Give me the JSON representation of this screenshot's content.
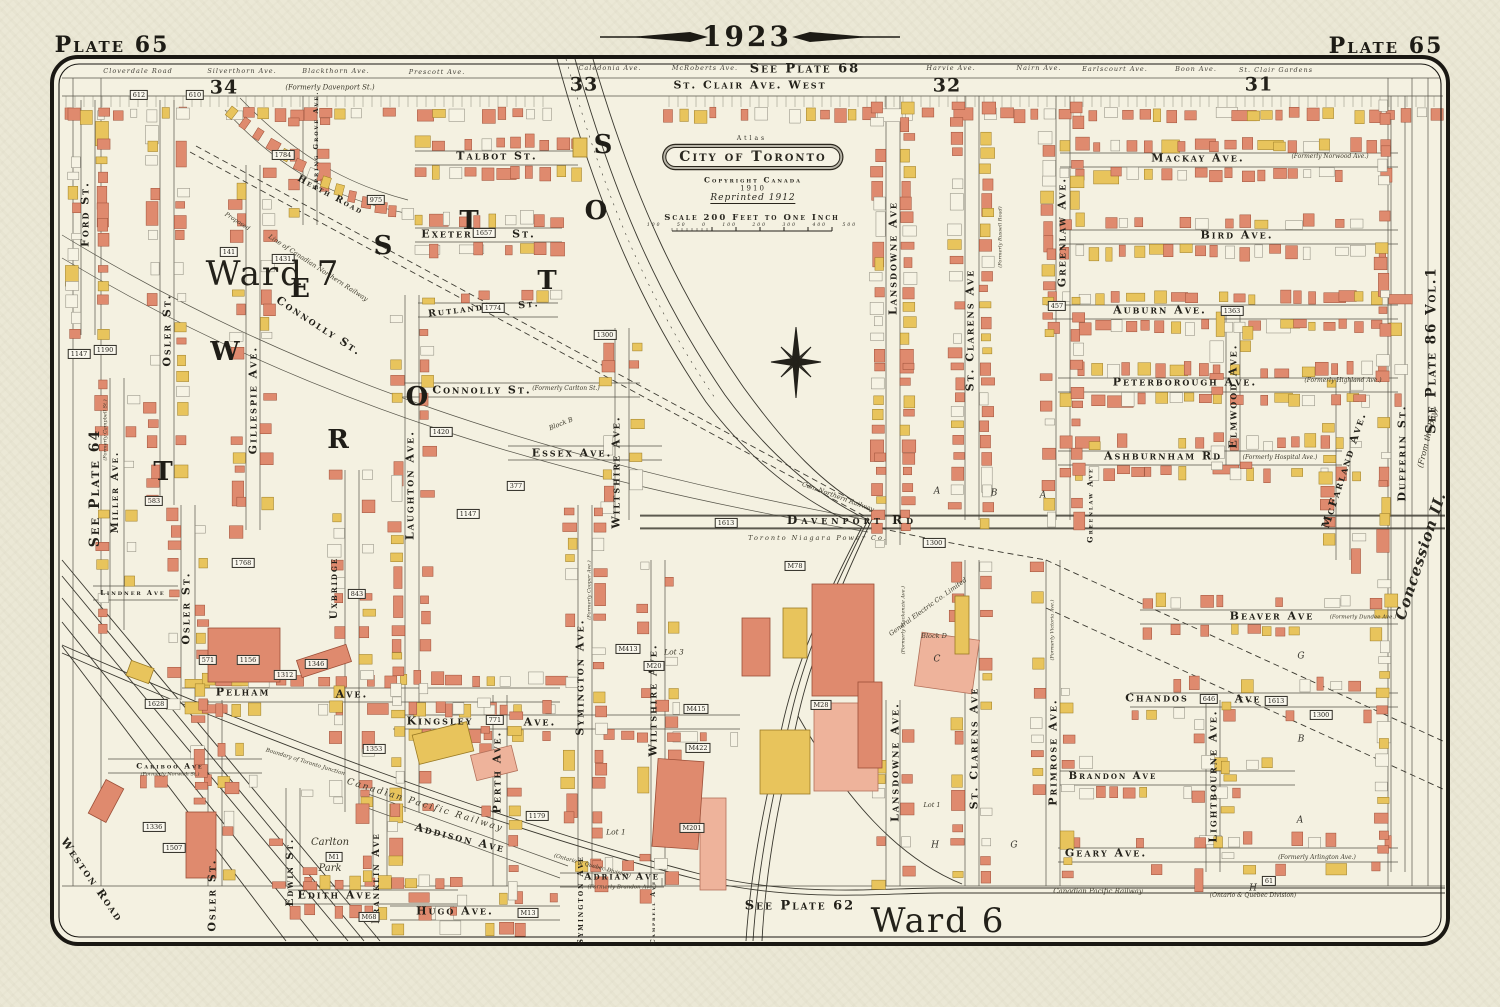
{
  "header": {
    "year": "1923",
    "plate_left": "Plate 65",
    "plate_right": "Plate 65"
  },
  "edges": {
    "top": "See Plate 68",
    "left": "See Plate 64",
    "right": "See Plate 86 Vol.1",
    "right_note": "(From the Bay)",
    "concession": "Concession II.",
    "bottom": "See Plate 62"
  },
  "wards": {
    "ward7": "Ward 7",
    "ward6": "Ward 6"
  },
  "railway_bottom": {
    "name": "Canadian Pacific Railway",
    "division": "(Ontario & Quebec Division)"
  },
  "cartouche": {
    "atlas": "Atlas",
    "title": "City of Toronto",
    "copyright": "Copyright Canada",
    "year": "1910",
    "reprint": "Reprinted 1912",
    "scale": "Scale 200 Feet to One Inch",
    "ticks": "100 50 0 100 200 300 400 500"
  },
  "top_row": {
    "st_clair": "St. Clair Ave. West",
    "streets": [
      {
        "t": "Cloverdale Road",
        "x": 138,
        "y": 71
      },
      {
        "t": "Silverthorn Ave.",
        "x": 242,
        "y": 71
      },
      {
        "t": "Blackthorn Ave.",
        "x": 336,
        "y": 71
      },
      {
        "t": "Prescott Ave.",
        "x": 437,
        "y": 72
      },
      {
        "t": "Caledonia Ave.",
        "x": 610,
        "y": 68
      },
      {
        "t": "McRoberts Ave.",
        "x": 705,
        "y": 68
      },
      {
        "t": "Harvie Ave.",
        "x": 951,
        "y": 68
      },
      {
        "t": "Nairn Ave.",
        "x": 1039,
        "y": 68
      },
      {
        "t": "Earlscourt Ave.",
        "x": 1115,
        "y": 69
      },
      {
        "t": "Boon Ave.",
        "x": 1196,
        "y": 69
      },
      {
        "t": "St. Clair Gardens",
        "x": 1276,
        "y": 70
      }
    ]
  },
  "sections": [
    {
      "n": "34",
      "x": 224,
      "y": 88,
      "note": "(Formerly Davenport St.)",
      "nx": 330,
      "ny": 88
    },
    {
      "n": "33",
      "x": 584,
      "y": 85
    },
    {
      "n": "32",
      "x": 947,
      "y": 86
    },
    {
      "n": "31",
      "x": 1259,
      "y": 85
    }
  ],
  "street_labels": [
    {
      "t": "Talbot St.",
      "x": 497,
      "y": 156,
      "s": 11
    },
    {
      "t": "Exeter",
      "x": 447,
      "y": 234,
      "s": 11
    },
    {
      "t": "St.",
      "x": 524,
      "y": 234,
      "s": 11
    },
    {
      "t": "Rutland",
      "x": 456,
      "y": 311,
      "s": 9.5,
      "r": -7
    },
    {
      "t": "St.",
      "x": 529,
      "y": 305,
      "s": 9.5,
      "r": -7
    },
    {
      "t": "Connolly St.",
      "x": 319,
      "y": 326,
      "s": 11,
      "r": 33
    },
    {
      "t": "Connolly St.",
      "x": 482,
      "y": 390,
      "s": 11
    },
    {
      "t": "Essex Ave.",
      "x": 572,
      "y": 453,
      "s": 11
    },
    {
      "t": "Davenport Rd",
      "x": 852,
      "y": 520,
      "s": 12,
      "ls": 4
    },
    {
      "t": "Pelham",
      "x": 243,
      "y": 692,
      "s": 11
    },
    {
      "t": "Ave.",
      "x": 352,
      "y": 694,
      "s": 11
    },
    {
      "t": "Kingsley",
      "x": 440,
      "y": 721,
      "s": 11
    },
    {
      "t": "Ave.",
      "x": 540,
      "y": 722,
      "s": 11
    },
    {
      "t": "Adrian Ave",
      "x": 622,
      "y": 877,
      "s": 9.5
    },
    {
      "t": "Addison Ave",
      "x": 460,
      "y": 838,
      "s": 11,
      "r": 14
    },
    {
      "t": "Edith Ave.",
      "x": 338,
      "y": 895,
      "s": 11
    },
    {
      "t": "Hugo Ave.",
      "x": 455,
      "y": 911,
      "s": 11
    },
    {
      "t": "Cariboo Ave",
      "x": 170,
      "y": 766,
      "s": 7.5
    },
    {
      "t": "Lindner Ave",
      "x": 133,
      "y": 593,
      "s": 6.5
    },
    {
      "t": "Mackay Ave.",
      "x": 1198,
      "y": 158,
      "s": 11
    },
    {
      "t": "Bird Ave.",
      "x": 1237,
      "y": 235,
      "s": 11
    },
    {
      "t": "Auburn Ave.",
      "x": 1160,
      "y": 310,
      "s": 11
    },
    {
      "t": "Peterborough Ave.",
      "x": 1185,
      "y": 382,
      "s": 11
    },
    {
      "t": "Ashburnham Rd",
      "x": 1163,
      "y": 456,
      "s": 11
    },
    {
      "t": "Beaver Ave",
      "x": 1272,
      "y": 616,
      "s": 11
    },
    {
      "t": "Chandos",
      "x": 1157,
      "y": 698,
      "s": 11
    },
    {
      "t": "Ave",
      "x": 1248,
      "y": 699,
      "s": 11
    },
    {
      "t": "Brandon Ave",
      "x": 1113,
      "y": 777,
      "s": 10
    },
    {
      "t": "Geary Ave.",
      "x": 1106,
      "y": 853,
      "s": 11
    },
    {
      "t": "Ford St.",
      "x": 85,
      "y": 214,
      "s": 11,
      "r": -90
    },
    {
      "t": "Osler St.",
      "x": 167,
      "y": 330,
      "s": 11,
      "r": -90
    },
    {
      "t": "Osler St.",
      "x": 186,
      "y": 608,
      "s": 11,
      "r": -90
    },
    {
      "t": "Osler St.",
      "x": 212,
      "y": 895,
      "s": 11,
      "r": -90
    },
    {
      "t": "Miller Ave.",
      "x": 116,
      "y": 492,
      "s": 10,
      "r": -90
    },
    {
      "t": "Gillespie Ave.",
      "x": 253,
      "y": 400,
      "s": 11,
      "r": -90
    },
    {
      "t": "Spring Grove Ave.",
      "x": 316,
      "y": 140,
      "s": 6.5,
      "r": -90
    },
    {
      "t": "Heath Road",
      "x": 330,
      "y": 196,
      "s": 9,
      "r": 28
    },
    {
      "t": "Laughton Ave.",
      "x": 410,
      "y": 485,
      "s": 11,
      "r": -90
    },
    {
      "t": "Uxbridge",
      "x": 335,
      "y": 588,
      "s": 10,
      "r": -90
    },
    {
      "t": "Wiltshire Ave.",
      "x": 616,
      "y": 472,
      "s": 11,
      "r": -90
    },
    {
      "t": "Wiltshire Ave.",
      "x": 653,
      "y": 700,
      "s": 11,
      "r": -90
    },
    {
      "t": "Symington Ave.",
      "x": 580,
      "y": 677,
      "s": 11,
      "r": -90
    },
    {
      "t": "Symington Ave",
      "x": 580,
      "y": 900,
      "s": 8,
      "r": -90
    },
    {
      "t": "Perth Ave.",
      "x": 497,
      "y": 772,
      "s": 11,
      "r": -90
    },
    {
      "t": "Franklin Ave",
      "x": 377,
      "y": 878,
      "s": 10,
      "r": -90
    },
    {
      "t": "Edwin St.",
      "x": 291,
      "y": 872,
      "s": 10,
      "r": -90
    },
    {
      "t": "Campbell Ave",
      "x": 654,
      "y": 912,
      "s": 6,
      "r": -90
    },
    {
      "t": "Lansdowne Ave",
      "x": 893,
      "y": 258,
      "s": 11,
      "r": -90
    },
    {
      "t": "Lansdowne Ave.",
      "x": 895,
      "y": 762,
      "s": 11,
      "r": -90
    },
    {
      "t": "St. Clarens Ave",
      "x": 970,
      "y": 330,
      "s": 11,
      "r": -90
    },
    {
      "t": "St. Clarens Ave",
      "x": 974,
      "y": 748,
      "s": 11,
      "r": -90
    },
    {
      "t": "Greenlaw Ave.",
      "x": 1062,
      "y": 232,
      "s": 11,
      "r": -90
    },
    {
      "t": "Greenlaw Ave",
      "x": 1090,
      "y": 505,
      "s": 7.5,
      "r": -90
    },
    {
      "t": "Primrose Ave.",
      "x": 1053,
      "y": 752,
      "s": 11,
      "r": -90
    },
    {
      "t": "Elmwood Ave.",
      "x": 1233,
      "y": 396,
      "s": 11,
      "r": -90
    },
    {
      "t": "McFarland Ave.",
      "x": 1344,
      "y": 470,
      "s": 11,
      "r": -72
    },
    {
      "t": "Lightbourne Ave.",
      "x": 1213,
      "y": 776,
      "s": 11,
      "r": -90
    },
    {
      "t": "Dufferin St.",
      "x": 1402,
      "y": 453,
      "s": 11,
      "r": -90
    },
    {
      "t": "Weston Road",
      "x": 92,
      "y": 880,
      "s": 11,
      "r": 55
    }
  ],
  "annotations": [
    {
      "t": "(Formerly Carlton St.)",
      "x": 566,
      "y": 389,
      "s": 6
    },
    {
      "t": "(Formerly Brandon Ave.)",
      "x": 622,
      "y": 888,
      "s": 5.5
    },
    {
      "t": "(Formerly Norwich St.)",
      "x": 170,
      "y": 775,
      "s": 5
    },
    {
      "t": "(Formerly Norwood Ave.)",
      "x": 1330,
      "y": 157,
      "s": 6
    },
    {
      "t": "(Formerly Highland Ave.)",
      "x": 1343,
      "y": 381,
      "s": 6
    },
    {
      "t": "(Formerly Hospital Ave.)",
      "x": 1280,
      "y": 458,
      "s": 6
    },
    {
      "t": "(Formerly Dundee Ave.)",
      "x": 1363,
      "y": 618,
      "s": 5.5
    },
    {
      "t": "(Formerly Arlington Ave.)",
      "x": 1317,
      "y": 858,
      "s": 6
    },
    {
      "t": "(Formerly Campbell St.)",
      "x": 106,
      "y": 430,
      "s": 5,
      "r": -90
    },
    {
      "t": "(Formerly Cooper Ave.)",
      "x": 590,
      "y": 590,
      "s": 5,
      "r": -90
    },
    {
      "t": "(Formerly Mackenzie Ave.)",
      "x": 904,
      "y": 620,
      "s": 5,
      "r": -90
    },
    {
      "t": "(Formerly Russell Road)",
      "x": 1001,
      "y": 237,
      "s": 5,
      "r": -90
    },
    {
      "t": "(Formerly Victoria Ave.)",
      "x": 1053,
      "y": 630,
      "s": 5,
      "r": -90
    },
    {
      "t": "Proposed",
      "x": 237,
      "y": 222,
      "s": 6,
      "r": 33
    },
    {
      "t": "Line of Canadian Northern Railway",
      "x": 318,
      "y": 268,
      "s": 6.5,
      "r": 33
    },
    {
      "t": "Can. Northern Railway",
      "x": 838,
      "y": 497,
      "s": 6.5,
      "r": 20
    },
    {
      "t": "Toronto Niagara Power Co.",
      "x": 818,
      "y": 538,
      "s": 6.5,
      "ls": 2
    },
    {
      "t": "General Electric Co. Limited",
      "x": 928,
      "y": 607,
      "s": 6.5,
      "r": -36
    },
    {
      "t": "Block D",
      "x": 934,
      "y": 636,
      "s": 6.5
    },
    {
      "t": "Block B",
      "x": 561,
      "y": 424,
      "s": 6.5,
      "r": -22
    },
    {
      "t": "Lot 3",
      "x": 674,
      "y": 652,
      "s": 7.5
    },
    {
      "t": "Lot 1",
      "x": 616,
      "y": 832,
      "s": 7.5
    },
    {
      "t": "Lot 1",
      "x": 932,
      "y": 805,
      "s": 6.5
    },
    {
      "t": "Carlton",
      "x": 330,
      "y": 843,
      "s": 10
    },
    {
      "t": "Park",
      "x": 330,
      "y": 869,
      "s": 10
    },
    {
      "t": "Boundary of Toronto Junction",
      "x": 305,
      "y": 763,
      "s": 5.5,
      "r": 17
    },
    {
      "t": "Canadian Pacific Railway",
      "x": 425,
      "y": 806,
      "s": 9,
      "r": 17,
      "ls": 2
    },
    {
      "t": "(Ontario & Quebec Division)",
      "x": 592,
      "y": 867,
      "s": 5.5,
      "r": 15
    }
  ],
  "big_letters": [
    {
      "t": "W",
      "x": 225,
      "y": 352
    },
    {
      "t": "E",
      "x": 300,
      "y": 289
    },
    {
      "t": "S",
      "x": 383,
      "y": 246
    },
    {
      "t": "T",
      "x": 469,
      "y": 221
    },
    {
      "t": "S",
      "x": 603,
      "y": 145
    },
    {
      "t": "O",
      "x": 596,
      "y": 211
    },
    {
      "t": "T",
      "x": 547,
      "y": 281
    },
    {
      "t": "R",
      "x": 338,
      "y": 440
    },
    {
      "t": "O",
      "x": 417,
      "y": 397
    },
    {
      "t": "T",
      "x": 163,
      "y": 472
    }
  ],
  "block_letters": [
    {
      "t": "A",
      "x": 937,
      "y": 492
    },
    {
      "t": "B",
      "x": 994,
      "y": 494
    },
    {
      "t": "A",
      "x": 1043,
      "y": 496
    },
    {
      "t": "C",
      "x": 937,
      "y": 660
    },
    {
      "t": "G",
      "x": 1014,
      "y": 846
    },
    {
      "t": "H",
      "x": 935,
      "y": 846
    },
    {
      "t": "B",
      "x": 1301,
      "y": 740
    },
    {
      "t": "A",
      "x": 1300,
      "y": 821
    },
    {
      "t": "G",
      "x": 1301,
      "y": 657
    },
    {
      "t": "H",
      "x": 1253,
      "y": 889
    }
  ],
  "markers": [
    {
      "t": "612",
      "x": 139,
      "y": 95
    },
    {
      "t": "610",
      "x": 195,
      "y": 95
    },
    {
      "t": "1784",
      "x": 283,
      "y": 155
    },
    {
      "t": "975",
      "x": 376,
      "y": 200
    },
    {
      "t": "141",
      "x": 229,
      "y": 252
    },
    {
      "t": "1431",
      "x": 283,
      "y": 259
    },
    {
      "t": "1657",
      "x": 484,
      "y": 233
    },
    {
      "t": "1774",
      "x": 493,
      "y": 308
    },
    {
      "t": "1300",
      "x": 605,
      "y": 335
    },
    {
      "t": "457",
      "x": 1057,
      "y": 306
    },
    {
      "t": "1363",
      "x": 1232,
      "y": 311
    },
    {
      "t": "1147",
      "x": 79,
      "y": 354
    },
    {
      "t": "1190",
      "x": 105,
      "y": 350
    },
    {
      "t": "583",
      "x": 154,
      "y": 501
    },
    {
      "t": "1768",
      "x": 243,
      "y": 563
    },
    {
      "t": "1420",
      "x": 441,
      "y": 432
    },
    {
      "t": "377",
      "x": 516,
      "y": 486
    },
    {
      "t": "1147",
      "x": 468,
      "y": 514
    },
    {
      "t": "843",
      "x": 357,
      "y": 594
    },
    {
      "t": "1613",
      "x": 726,
      "y": 523
    },
    {
      "t": "1300",
      "x": 934,
      "y": 543
    },
    {
      "t": "M78",
      "x": 795,
      "y": 566
    },
    {
      "t": "M413",
      "x": 628,
      "y": 649
    },
    {
      "t": "M20",
      "x": 654,
      "y": 666
    },
    {
      "t": "M415",
      "x": 696,
      "y": 709
    },
    {
      "t": "M422",
      "x": 698,
      "y": 748
    },
    {
      "t": "M28",
      "x": 821,
      "y": 705
    },
    {
      "t": "M201",
      "x": 692,
      "y": 828
    },
    {
      "t": "571",
      "x": 208,
      "y": 660
    },
    {
      "t": "1156",
      "x": 248,
      "y": 660
    },
    {
      "t": "1312",
      "x": 285,
      "y": 675
    },
    {
      "t": "1346",
      "x": 316,
      "y": 664
    },
    {
      "t": "1628",
      "x": 156,
      "y": 704
    },
    {
      "t": "1353",
      "x": 374,
      "y": 749
    },
    {
      "t": "771",
      "x": 495,
      "y": 720
    },
    {
      "t": "1179",
      "x": 537,
      "y": 816
    },
    {
      "t": "1336",
      "x": 154,
      "y": 827
    },
    {
      "t": "1507",
      "x": 174,
      "y": 848
    },
    {
      "t": "M1",
      "x": 334,
      "y": 857
    },
    {
      "t": "M68",
      "x": 369,
      "y": 917
    },
    {
      "t": "M13",
      "x": 528,
      "y": 913
    },
    {
      "t": "646",
      "x": 1209,
      "y": 699
    },
    {
      "t": "1613",
      "x": 1276,
      "y": 701
    },
    {
      "t": "1300",
      "x": 1321,
      "y": 715
    },
    {
      "t": "61",
      "x": 1269,
      "y": 881
    }
  ],
  "palette": {
    "paper": "#ebe8d6",
    "map": "#f4f1e1",
    "ink": "#23211a",
    "line": "#57554a",
    "rail": "#3a382f",
    "building_red": "#df8a6e",
    "building_red_stroke": "#9c4f38",
    "building_red_light": "#eeb39b",
    "building_red_light_stroke": "#b2705a",
    "building_yellow": "#e8c45c",
    "building_yellow_stroke": "#9a7b25",
    "lot_white": "#f6f3e4",
    "lot_white_stroke": "#8a877a"
  }
}
